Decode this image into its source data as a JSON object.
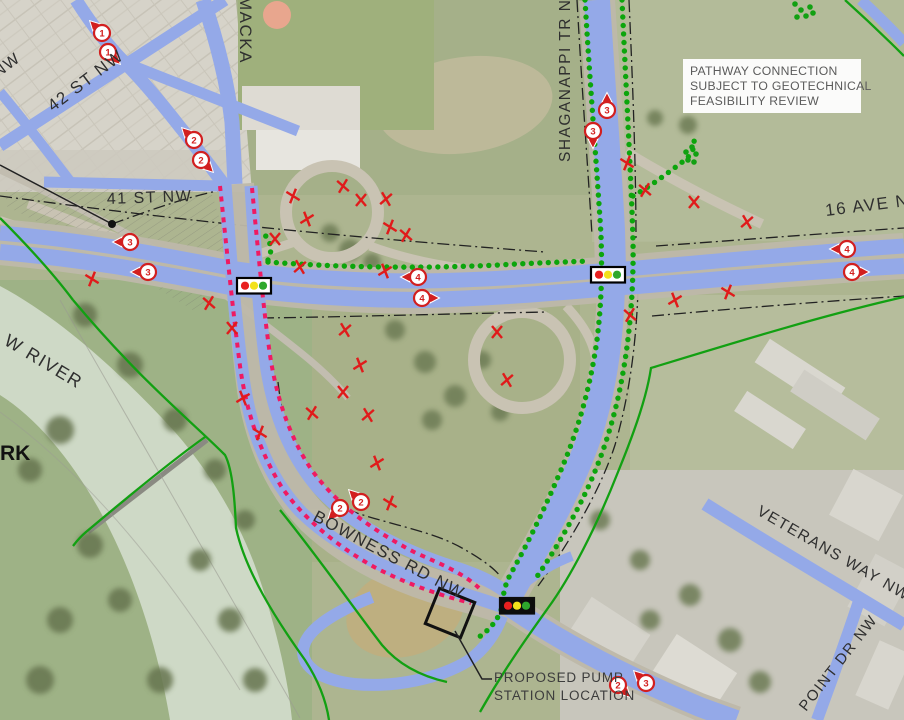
{
  "map": {
    "street_labels": {
      "st42": "42 ST NW",
      "st41": "41 ST NW",
      "mackay": "MACKA",
      "shaganappi": "SHAGANAPPI TR NW",
      "ave16": "16 AVE N",
      "bowness": "BOWNESS RD NW",
      "veterans": "VETERANS WAY NW",
      "point": "POINT DR NW",
      "river": "W RIVER",
      "park": "RK",
      "nw_partial": "NW"
    },
    "notes": {
      "pathway_line1": "PATHWAY CONNECTION",
      "pathway_line2": "SUBJECT TO GEOTECHNICAL",
      "pathway_line3": "FEASIBILITY REVIEW",
      "pump_line1": "PROPOSED PUMP",
      "pump_line2": "STATION LOCATION"
    },
    "colors": {
      "road_overlay": "#94a9e8",
      "pathway_green": "#12a012",
      "removal_red": "#e01b1b",
      "route_pink": "#ef1a62",
      "marker_red": "#d21f1f",
      "signal_red": "#e8201f",
      "signal_yellow": "#f2e11c",
      "signal_green": "#2ea82c"
    },
    "route_markers": [
      {
        "number": "1",
        "x": 102,
        "y": 33,
        "dir": "nw"
      },
      {
        "number": "1",
        "x": 108,
        "y": 52,
        "dir": "se"
      },
      {
        "number": "2",
        "x": 194,
        "y": 140,
        "dir": "nw"
      },
      {
        "number": "2",
        "x": 201,
        "y": 160,
        "dir": "se"
      },
      {
        "number": "3",
        "x": 130,
        "y": 242,
        "dir": "w"
      },
      {
        "number": "3",
        "x": 148,
        "y": 272,
        "dir": "w"
      },
      {
        "number": "3",
        "x": 607,
        "y": 110,
        "dir": "n"
      },
      {
        "number": "3",
        "x": 593,
        "y": 131,
        "dir": "s"
      },
      {
        "number": "4",
        "x": 418,
        "y": 277,
        "dir": "w"
      },
      {
        "number": "4",
        "x": 422,
        "y": 298,
        "dir": "e"
      },
      {
        "number": "4",
        "x": 847,
        "y": 249,
        "dir": "w"
      },
      {
        "number": "4",
        "x": 852,
        "y": 272,
        "dir": "e"
      },
      {
        "number": "2",
        "x": 340,
        "y": 508,
        "dir": "sw"
      },
      {
        "number": "2",
        "x": 361,
        "y": 502,
        "dir": "nw"
      },
      {
        "number": "2",
        "x": 618,
        "y": 685,
        "dir": "se"
      },
      {
        "number": "3",
        "x": 646,
        "y": 683,
        "dir": "nw"
      }
    ],
    "removal_marks": [
      [
        293,
        196
      ],
      [
        343,
        186
      ],
      [
        361,
        200
      ],
      [
        386,
        199
      ],
      [
        307,
        219
      ],
      [
        390,
        227
      ],
      [
        406,
        235
      ],
      [
        275,
        239
      ],
      [
        300,
        267
      ],
      [
        385,
        271
      ],
      [
        92,
        279
      ],
      [
        209,
        303
      ],
      [
        232,
        328
      ],
      [
        345,
        330
      ],
      [
        360,
        365
      ],
      [
        627,
        163
      ],
      [
        645,
        190
      ],
      [
        694,
        202
      ],
      [
        747,
        222
      ],
      [
        675,
        300
      ],
      [
        728,
        292
      ],
      [
        630,
        315
      ],
      [
        497,
        332
      ],
      [
        507,
        380
      ],
      [
        243,
        398
      ],
      [
        260,
        433
      ],
      [
        312,
        413
      ],
      [
        343,
        392
      ],
      [
        368,
        415
      ],
      [
        377,
        463
      ],
      [
        390,
        503
      ]
    ],
    "signals": [
      {
        "x": 237,
        "y": 278,
        "style": "light"
      },
      {
        "x": 591,
        "y": 267,
        "style": "light"
      },
      {
        "x": 500,
        "y": 598,
        "style": "dark"
      }
    ],
    "dot_clusters": [
      [
        686,
        152
      ],
      [
        692,
        147
      ],
      [
        696,
        154
      ],
      [
        688,
        160
      ],
      [
        694,
        162
      ],
      [
        795,
        4
      ],
      [
        801,
        10
      ],
      [
        806,
        16
      ],
      [
        797,
        17
      ],
      [
        810,
        7
      ],
      [
        813,
        13
      ]
    ]
  }
}
